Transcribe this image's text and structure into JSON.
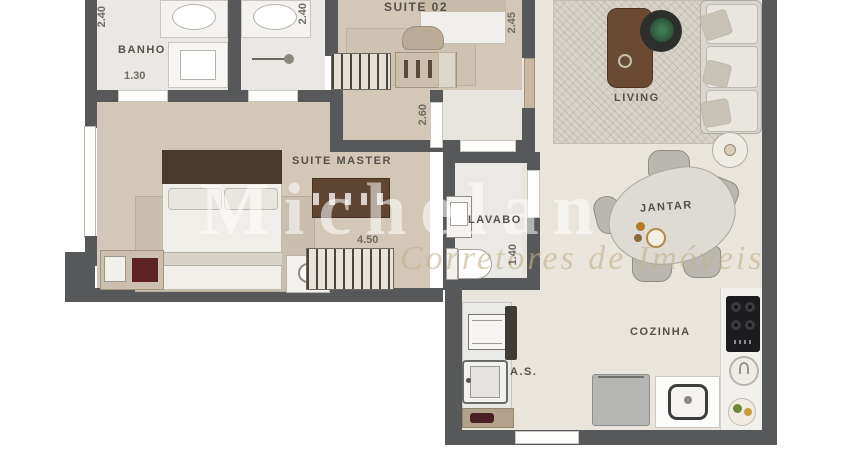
{
  "plan": {
    "rooms": [
      {
        "label": "BANHO"
      },
      {
        "label": "SUITE 02"
      },
      {
        "label": "SUITE MASTER"
      },
      {
        "label": "LAVABO"
      },
      {
        "label": "LIVING"
      },
      {
        "label": "JANTAR"
      },
      {
        "label": "COZINHA"
      },
      {
        "label": "A.S."
      }
    ],
    "dims": [
      {
        "value": "2.40"
      },
      {
        "value": "2.40"
      },
      {
        "value": "2.45"
      },
      {
        "value": "2.60"
      },
      {
        "value": "1.30"
      },
      {
        "value": "4.50"
      },
      {
        "value": "1.40"
      }
    ],
    "watermark": {
      "title": "Michelan",
      "subtitle": "Corretores de Imóveis"
    },
    "colors": {
      "wall": "#57585a",
      "bedroom_floor": "#d3c7b7",
      "bath_floor": "#eae8e4",
      "living_floor": "#e9e5dd",
      "headboard": "#4a3a2d",
      "wood_furniture": "#6a4a33",
      "cooktop": "#1c1c1e"
    }
  }
}
